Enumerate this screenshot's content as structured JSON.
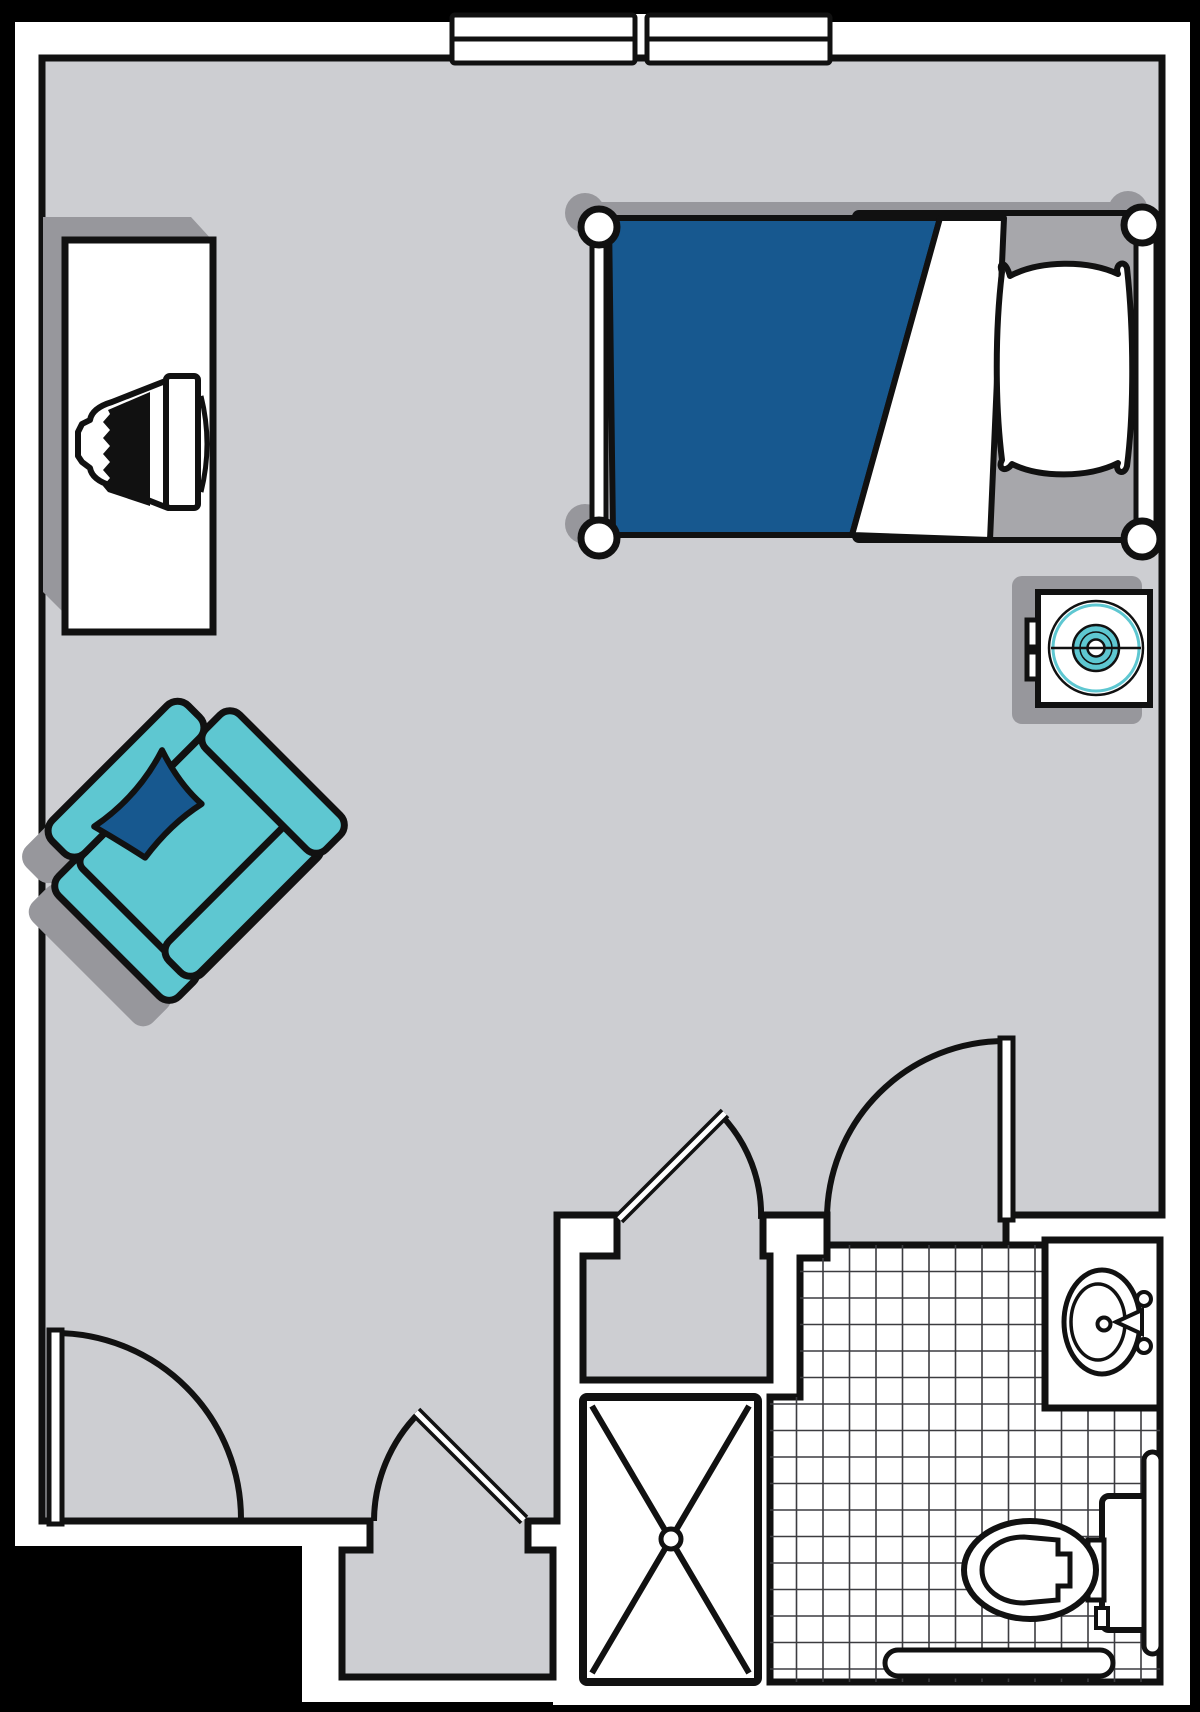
{
  "document": {
    "kind": "floor-plan",
    "unit_type": "studio-suite",
    "visible_text": []
  },
  "colors": {
    "bg": "#000000",
    "wall": "#ffffff",
    "floor": "#cdced2",
    "line": "#111111",
    "shadow": "#97979c",
    "mattress": "#a7a7ab",
    "blanket": "#17588f",
    "accent-teal": "#5ec7d1",
    "tile-line": "#3c3c40"
  },
  "rooms": [
    {
      "name": "main-living-sleeping-room",
      "floor": "carpet-gray"
    },
    {
      "name": "bathroom",
      "floor": "tile-grid"
    },
    {
      "name": "closet-upper",
      "floor": "carpet-gray"
    },
    {
      "name": "closet-alcove-lower",
      "floor": "carpet-gray"
    }
  ],
  "furniture": [
    {
      "name": "bed-twin",
      "details": [
        "blue-blanket",
        "white-fold",
        "pillow",
        "four-bedposts",
        "side-rails"
      ]
    },
    {
      "name": "desk-dresser-with-tv"
    },
    {
      "name": "armchair-rotated-45deg",
      "details": [
        "navy-throw-pillow"
      ]
    },
    {
      "name": "fan-unit-on-stand"
    }
  ],
  "fixtures": [
    {
      "name": "sink-vanity",
      "details": [
        "oval-basin",
        "faucet",
        "two-handles"
      ]
    },
    {
      "name": "toilet",
      "details": [
        "tank",
        "oval-bowl"
      ]
    },
    {
      "name": "shower-stall",
      "details": [
        "x-brace",
        "center-drain"
      ]
    },
    {
      "name": "grab-bar-vertical"
    },
    {
      "name": "grab-bar-horizontal"
    }
  ],
  "doors": [
    {
      "name": "entry-door",
      "swing": "into-room-from-south-west"
    },
    {
      "name": "closet-door-lower",
      "swing": "into-room-45deg"
    },
    {
      "name": "closet-door-upper",
      "swing": "into-room-45deg"
    },
    {
      "name": "bathroom-door",
      "swing": "into-room-fully-open"
    }
  ],
  "windows": [
    {
      "name": "window-left",
      "wall": "north"
    },
    {
      "name": "window-right",
      "wall": "north"
    }
  ]
}
